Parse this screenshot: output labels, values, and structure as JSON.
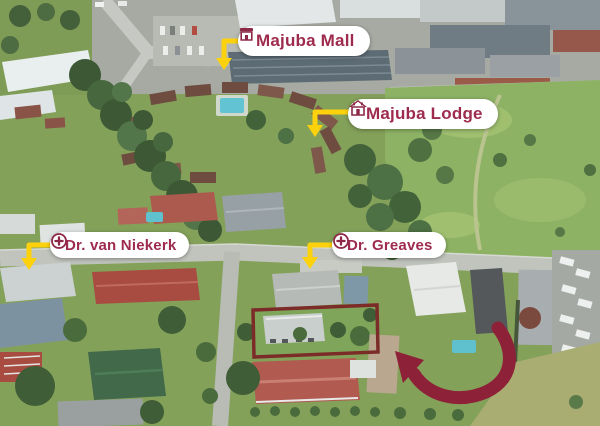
{
  "figure": {
    "type": "annotated-aerial-photo",
    "description": "Aerial drone photo of a neighbourhood showing nearby amenities and a highlighted property",
    "width_px": 600,
    "height_px": 426
  },
  "labels": [
    {
      "name": "majuba-mall",
      "text": "Majuba Mall",
      "icon": "storefront-icon"
    },
    {
      "name": "majuba-lodge",
      "text": "Majuba Lodge",
      "icon": "lodge-icon"
    },
    {
      "name": "dr-van-niekerk",
      "text": "Dr. van Niekerk",
      "icon": "medical-cross-icon"
    },
    {
      "name": "dr-greaves",
      "text": "Dr. Greaves",
      "icon": "medical-cross-icon"
    }
  ],
  "annotations": {
    "property_outline": {
      "shape": "rectangle",
      "color": "#7c2c28"
    },
    "highlight_arrow": {
      "shape": "curved-arrow",
      "color": "#8c2138"
    },
    "pointer_arrows": {
      "count": 4,
      "color": "#fdd20d"
    }
  },
  "colors": {
    "label_text": "#9e2b4d",
    "label_background": "#ffffff",
    "pointer_arrow_yellow": "#fdd20d",
    "property_outline_red": "#7c2c28",
    "highlight_arrow_red": "#8c2138"
  }
}
